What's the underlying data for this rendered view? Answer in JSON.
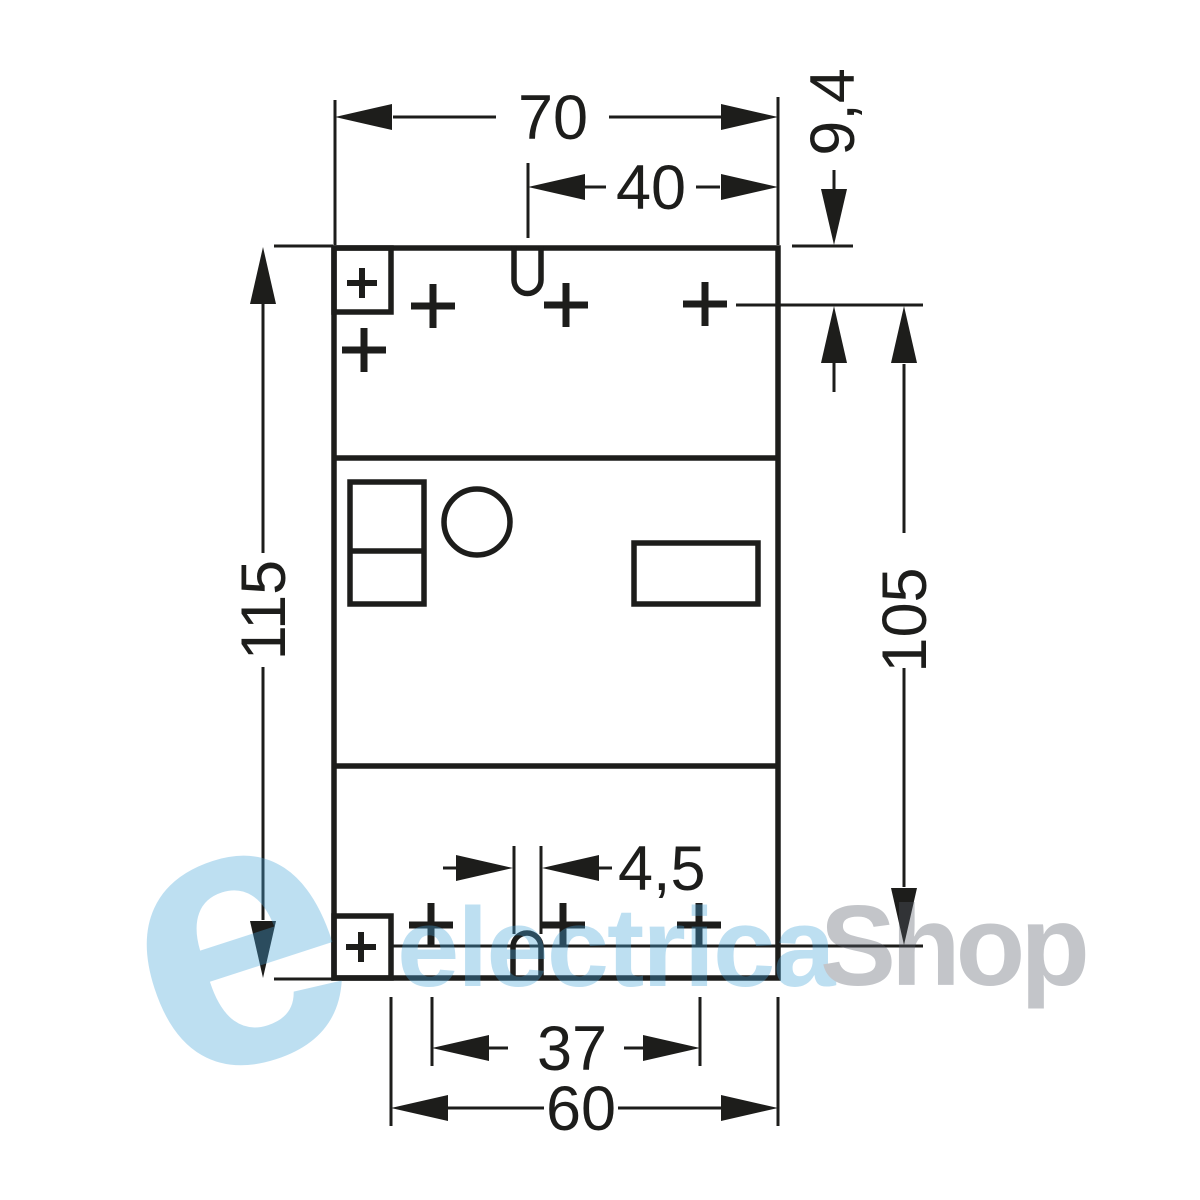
{
  "drawing": {
    "title": "device-mounting-dimension-drawing",
    "dimensions": {
      "overall_width": "70",
      "slot_to_edge_width": "40",
      "top_hole_offset": "9,4",
      "overall_height": "115",
      "hole_span_height": "105",
      "slot_width": "4,5",
      "hole_span_width": "37",
      "lower_width": "60"
    },
    "line_color": "#1d1d1b",
    "background": "#ffffff"
  },
  "watermark": {
    "emblem_letter": "e",
    "name_part1": "electrica",
    "name_part2": "Shop",
    "blue": "#45a4da",
    "gray": "#565c68",
    "opacity": "0.35"
  }
}
